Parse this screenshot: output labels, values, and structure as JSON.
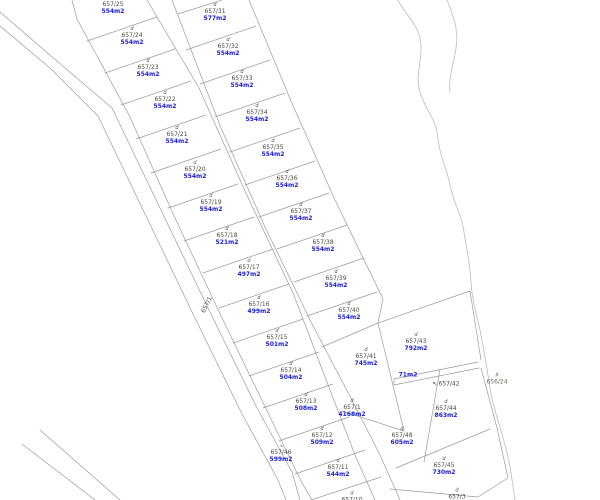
{
  "map": {
    "title": "cadastral-parcel-map",
    "colors": {
      "background": "#ffffff",
      "boundary_line": "#9a9a9a",
      "stream_line": "#c2c2c2",
      "parcel_number_text": "#4a4a40",
      "parcel_area_text": "#1c1cd8"
    },
    "labels": [
      {
        "name": "657/25",
        "area": "554m2",
        "mark": "d",
        "x": 113,
        "y": 5
      },
      {
        "name": "657/24",
        "area": "554m2",
        "mark": "d",
        "x": 132,
        "y": 36
      },
      {
        "name": "657/23",
        "area": "554m2",
        "mark": "d",
        "x": 148,
        "y": 68
      },
      {
        "name": "657/22",
        "area": "554m2",
        "mark": "d",
        "x": 165,
        "y": 100
      },
      {
        "name": "657/21",
        "area": "554m2",
        "mark": "d",
        "x": 177,
        "y": 135
      },
      {
        "name": "657/20",
        "area": "554m2",
        "mark": "d",
        "x": 195,
        "y": 170
      },
      {
        "name": "657/19",
        "area": "554m2",
        "mark": "d",
        "x": 211,
        "y": 203
      },
      {
        "name": "657/18",
        "area": "521m2",
        "mark": "d",
        "x": 227,
        "y": 236
      },
      {
        "name": "657/17",
        "area": "497m2",
        "mark": "d",
        "x": 249,
        "y": 268
      },
      {
        "name": "657/16",
        "area": "499m2",
        "mark": "d",
        "x": 259,
        "y": 305
      },
      {
        "name": "657/15",
        "area": "501m2",
        "mark": "d",
        "x": 277,
        "y": 338
      },
      {
        "name": "657/14",
        "area": "504m2",
        "mark": "d",
        "x": 291,
        "y": 371
      },
      {
        "name": "657/13",
        "area": "508m2",
        "mark": "d",
        "x": 306,
        "y": 402
      },
      {
        "name": "657/12",
        "area": "509m2",
        "mark": "d",
        "x": 322,
        "y": 436
      },
      {
        "name": "657/11",
        "area": "544m2",
        "mark": "d",
        "x": 338,
        "y": 468
      },
      {
        "name": "657/46",
        "area": "599m2",
        "mark": "arrow-down",
        "x": 281,
        "y": 453
      },
      {
        "name": "657/10",
        "area": "",
        "mark": "d",
        "x": 352,
        "y": 497
      },
      {
        "name": "657/31",
        "area": "577m2",
        "mark": "d",
        "x": 215,
        "y": 12
      },
      {
        "name": "657/32",
        "area": "554m2",
        "mark": "d",
        "x": 228,
        "y": 47
      },
      {
        "name": "657/33",
        "area": "554m2",
        "mark": "d",
        "x": 242,
        "y": 79
      },
      {
        "name": "657/34",
        "area": "554m2",
        "mark": "d",
        "x": 257,
        "y": 113
      },
      {
        "name": "657/35",
        "area": "554m2",
        "mark": "d",
        "x": 273,
        "y": 148
      },
      {
        "name": "657/36",
        "area": "554m2",
        "mark": "d",
        "x": 287,
        "y": 179
      },
      {
        "name": "657/37",
        "area": "554m2",
        "mark": "d",
        "x": 301,
        "y": 212
      },
      {
        "name": "657/38",
        "area": "554m2",
        "mark": "d",
        "x": 323,
        "y": 243
      },
      {
        "name": "657/39",
        "area": "554m2",
        "mark": "d",
        "x": 336,
        "y": 279
      },
      {
        "name": "657/40",
        "area": "554m2",
        "mark": "d",
        "x": 349,
        "y": 311
      },
      {
        "name": "657/41",
        "area": "745m2",
        "mark": "d",
        "x": 366,
        "y": 357
      },
      {
        "name": "657/43",
        "area": "792m2",
        "mark": "d",
        "x": 416,
        "y": 342
      },
      {
        "name": "",
        "area": "71m2",
        "mark": "",
        "x": 408,
        "y": 375
      },
      {
        "name": "657/42",
        "area": "",
        "mark": "arrow-left",
        "x": 446,
        "y": 384
      },
      {
        "name": "657/44",
        "area": "863m2",
        "mark": "d",
        "x": 446,
        "y": 409
      },
      {
        "name": "657/48",
        "area": "605m2",
        "mark": "d",
        "x": 402,
        "y": 436
      },
      {
        "name": "657/45",
        "area": "730m2",
        "mark": "d",
        "x": 444,
        "y": 466
      },
      {
        "name": "657/3",
        "area": "",
        "mark": "d",
        "x": 457,
        "y": 494
      },
      {
        "name": "656/24",
        "area": "",
        "mark": "II",
        "x": 497,
        "y": 379,
        "muted": true
      },
      {
        "name": "657/1",
        "area": "4168m2",
        "mark": "d",
        "x": 352,
        "y": 408
      },
      {
        "name": "657/1",
        "area": "",
        "mark": "",
        "x": 207,
        "y": 305,
        "rot": -64
      }
    ]
  }
}
